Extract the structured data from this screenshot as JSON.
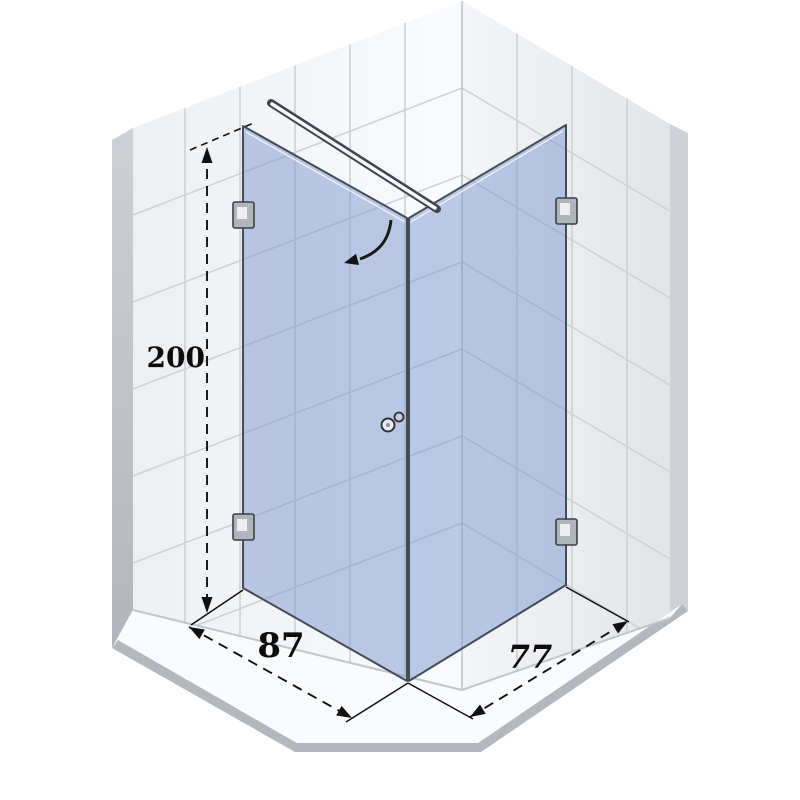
{
  "page": {
    "background": "#ffffff",
    "description": "Technical drawing of a corner shower enclosure with two glass panels"
  },
  "diagram": {
    "kind": "shower-enclosure-technical-drawing",
    "view": "isometric-corner",
    "annotations": {
      "height_label": "200",
      "left_width_label": "87",
      "right_width_label": "77"
    },
    "colors": {
      "glass": "#7a97cd",
      "glass_edge": "#454c58",
      "tile_grout": "#ced1d5",
      "wall_edge_band": "#c3c7cc",
      "floor_front_band": "#b4b8bc",
      "floor": "#fafbfc",
      "dimension_ink": "#111111",
      "hardware": "#b0b5bb"
    },
    "parts": {
      "left_wall": "tiled wall left",
      "right_wall": "tiled wall right",
      "floor": "shower base",
      "left_glass_panel": "hinged glass door panel",
      "right_glass_panel": "fixed glass side panel",
      "support_bar": "wall stabiliser bar",
      "door_handle": "knob handle",
      "wall_bracket": "glass mounting bracket",
      "swing_arrow": "door opening direction arrow"
    }
  }
}
